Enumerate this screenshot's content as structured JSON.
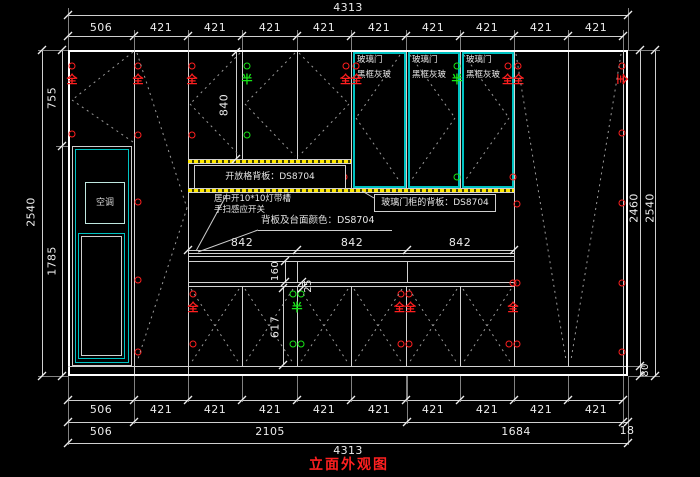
{
  "drawing": {
    "title": "立面外观图",
    "air_conditioner_label": "空调",
    "glass_door_label_line1": "玻璃门",
    "glass_door_label_line2": "黑框灰玻",
    "open_shelf_back_label": "开放格背板：DS8704",
    "glass_cabinet_back_label": "玻璃门柜的背板：DS8704",
    "led_slot_note": "居中开10*10灯带槽",
    "sensor_switch_note": "手扫感应开关",
    "surface_color_note": "背板及台面颜色：DS8704",
    "hinge_full_symbol": "全",
    "hinge_half_symbol": "半"
  },
  "dimensions": {
    "total_width_top": "4313",
    "top_segments": [
      "506",
      "421",
      "421",
      "421",
      "421",
      "421",
      "421",
      "421",
      "421",
      "421"
    ],
    "left_upper_height": "755",
    "left_total_height": "2540",
    "left_lower_height": "1785",
    "right_inner_height": "2460",
    "right_total_height": "2540",
    "base_height": "80",
    "upper_door_height": "840",
    "counter_segments": [
      "842",
      "842",
      "842"
    ],
    "drawer_height": "160",
    "gap_height": "25",
    "lower_door_height": "617",
    "bottom_segments": [
      "506",
      "421",
      "421",
      "421",
      "421",
      "421",
      "421",
      "421",
      "421",
      "421"
    ],
    "bottom_groups": [
      "506",
      "2105",
      "1684",
      "18"
    ],
    "total_width_bottom": "4313"
  },
  "colors": {
    "background": "#000000",
    "line": "#d2d2d2",
    "dash": "#9a9a9a",
    "teal": "#00c2c2",
    "yellow": "#ffe800",
    "hinge_full_red": "#ff1f1f",
    "hinge_half_green": "#17e617",
    "title_red": "#ff2020"
  }
}
